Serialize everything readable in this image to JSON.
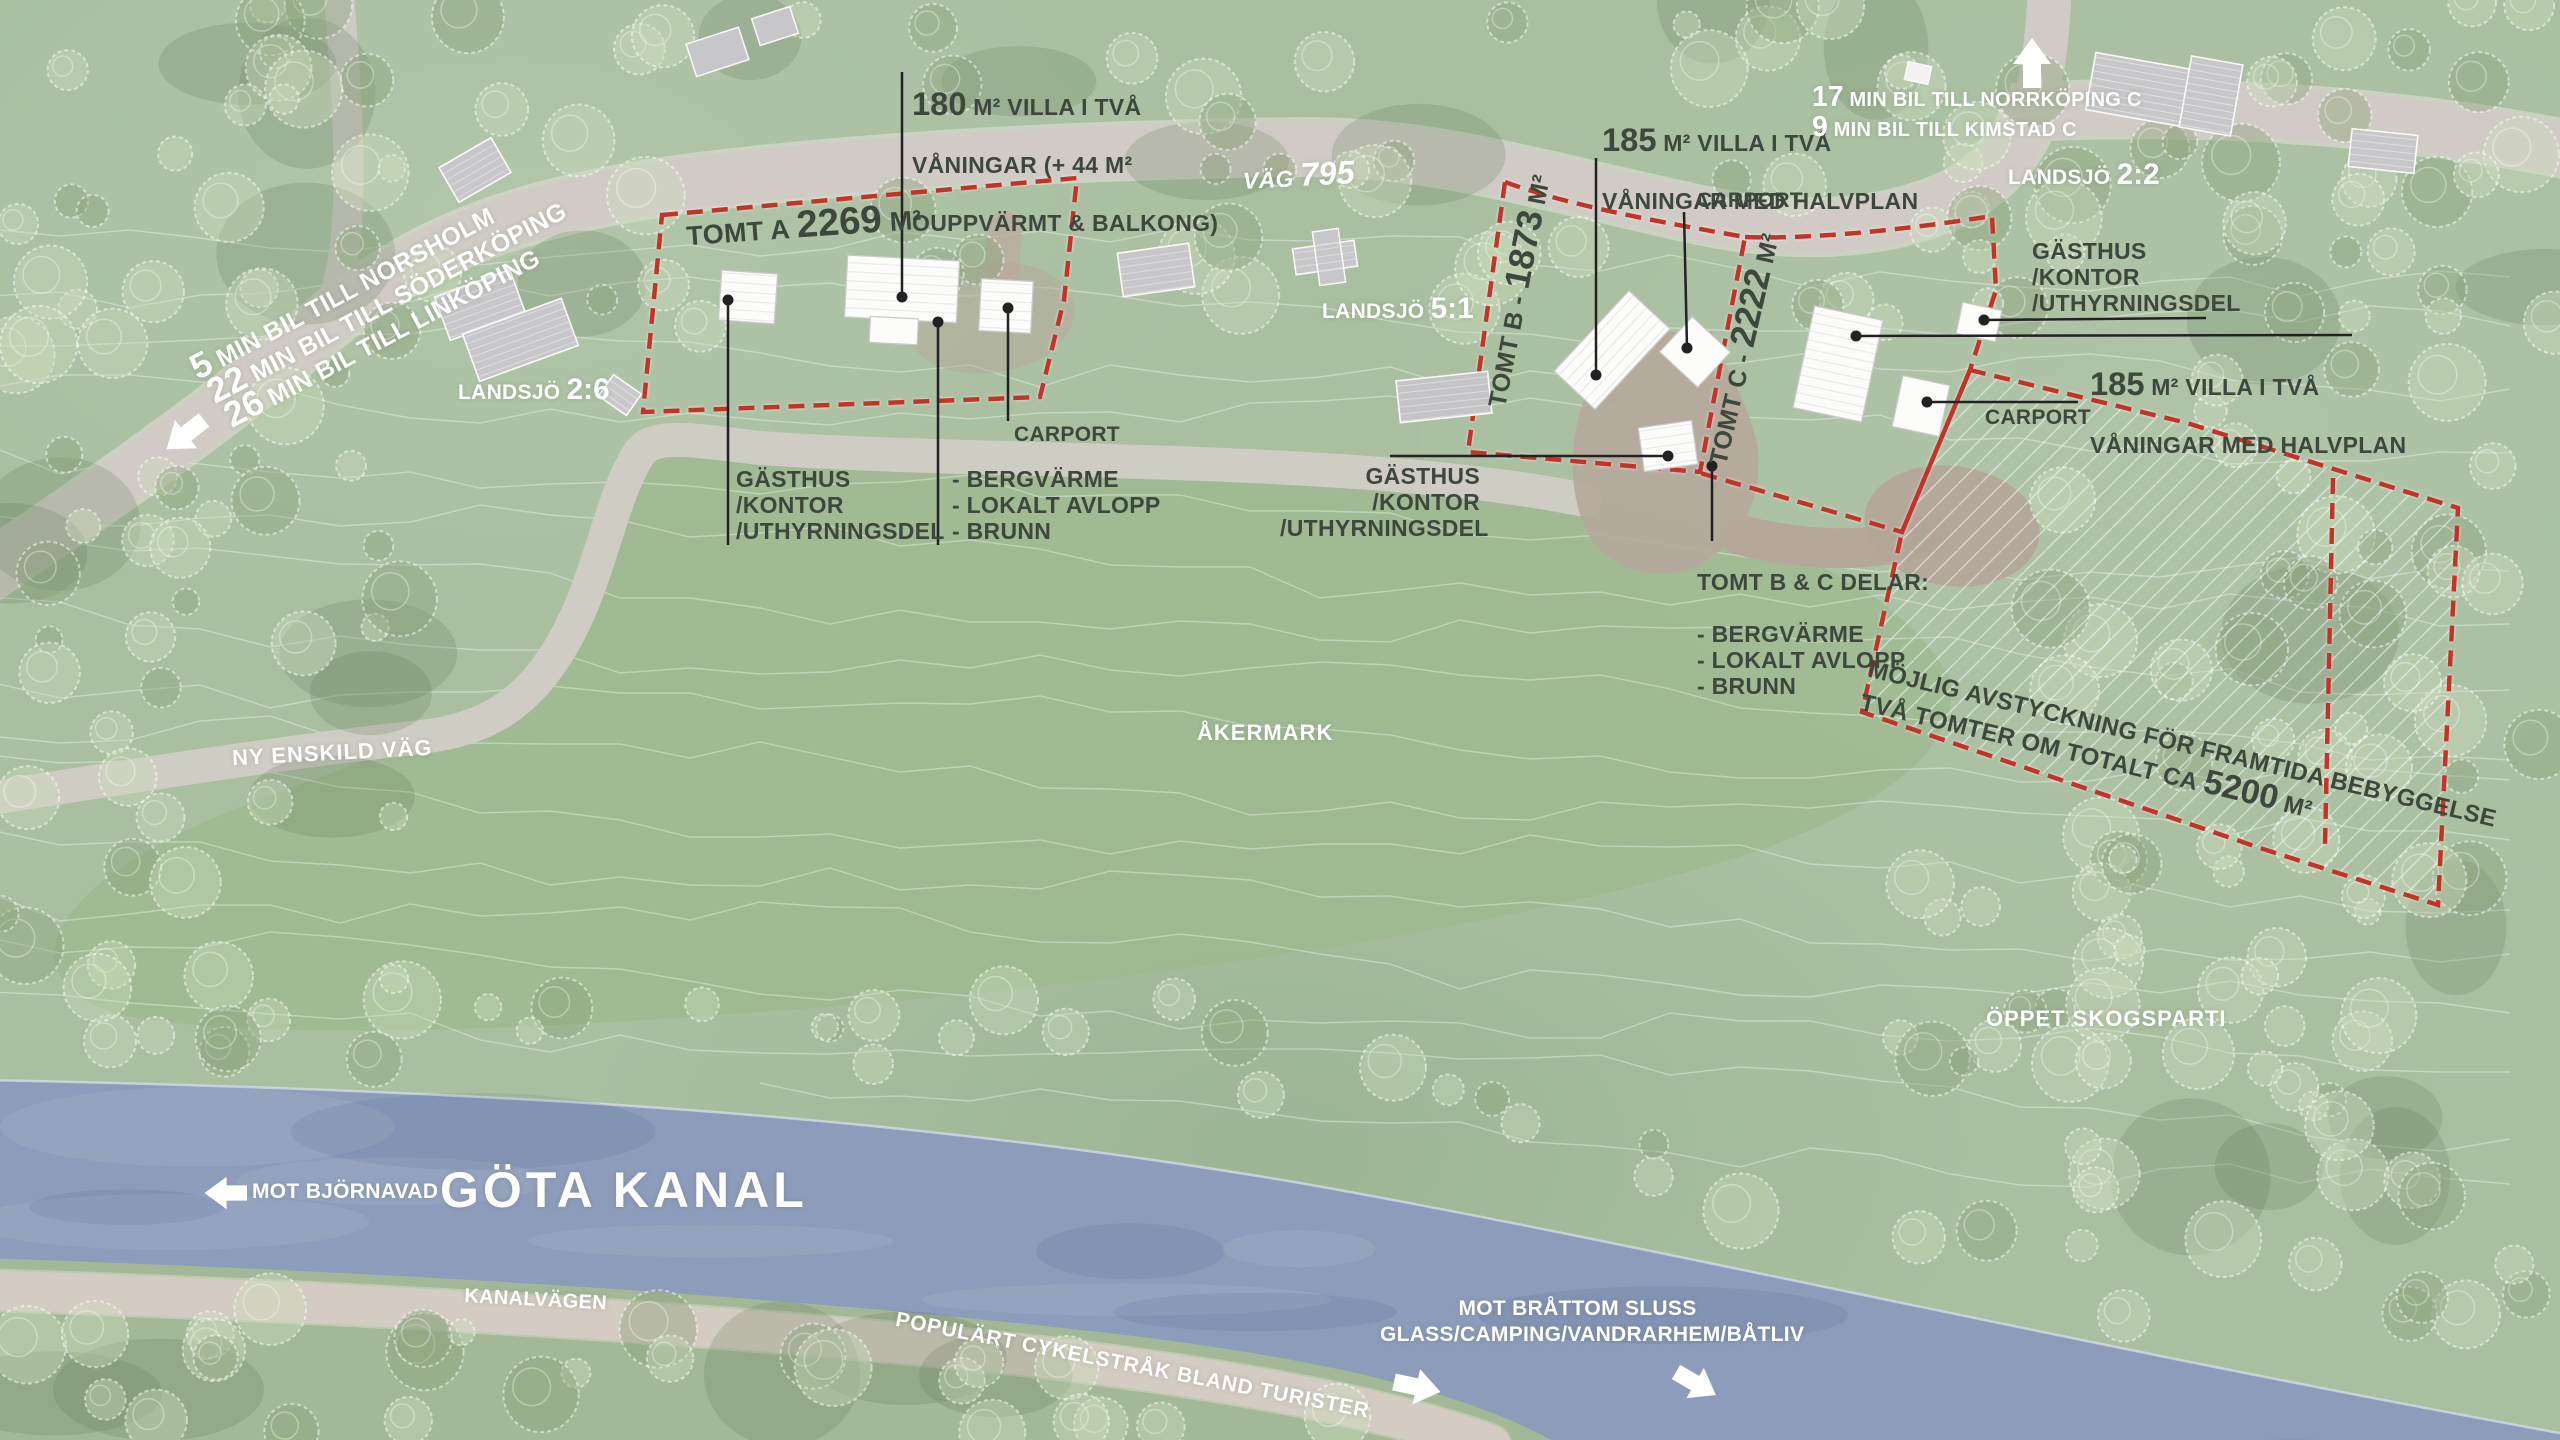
{
  "colors": {
    "background_green": "#a9bfa0",
    "field_green": "#9eb88f",
    "water_blue": "#8d9cbb",
    "road_gray": "#d0ccc5",
    "gravel_brown": "#b5a89b",
    "boundary_red": "#c23429",
    "label_dark": "#3e473c",
    "label_white": "#ffffff"
  },
  "plots": {
    "tomt_a": {
      "prefix": "TOMT A",
      "area": "2269",
      "unit": "M²"
    },
    "tomt_b": {
      "prefix": "TOMT B -",
      "area": "1873",
      "unit": "M²"
    },
    "tomt_c": {
      "prefix": "TOMT C -",
      "area": "2222",
      "unit": "M²"
    },
    "future": {
      "line1": "MÖJLIG AVSTYCKNING FÖR FRAMTIDA BEBYGGELSE",
      "line2_pre": "TVÅ TOMTER OM TOTALT CA",
      "line2_num": "5200",
      "line2_unit": "M²"
    }
  },
  "villas": {
    "villa_a": {
      "num": "180",
      "l1": " M² VILLA I TVÅ",
      "l2": "VÅNINGAR (+ 44 M²",
      "l3": "OUPPVÄRMT & BALKONG)"
    },
    "villa_b": {
      "num": "185",
      "l1": " M² VILLA I TVÅ",
      "l2": "VÅNINGAR MED HALVPLAN"
    },
    "villa_c": {
      "num": "185",
      "l1": " M² VILLA I TVÅ",
      "l2": "VÅNINGAR MED HALVPLAN"
    }
  },
  "annotations": {
    "gasthus_a": "GÄSTHUS\n/KONTOR\n/UTHYRNINGSDEL",
    "gasthus_b": "GÄSTHUS\n/KONTOR\n/UTHYRNINGSDEL",
    "gasthus_c": "GÄSTHUS\n/KONTOR\n/UTHYRNINGSDEL",
    "carport_a": "CARPORT",
    "carport_b": "CARPORT",
    "carport_c": "CARPORT",
    "utilities_a": "- BERGVÄRME\n- LOKALT AVLOPP\n- BRUNN",
    "utilities_bc_title": "TOMT B & C DELAR:",
    "utilities_bc_list": "- BERGVÄRME\n- LOKALT AVLOPP\n- BRUNN"
  },
  "roads": {
    "vag795": {
      "name": "VÄG",
      "number": "795"
    },
    "ny_enskild": "NY ENSKILD VÄG",
    "kanalvagen": "KANALVÄGEN",
    "cykelstrak": "POPULÄRT CYKELSTRÅK BLAND TURISTER"
  },
  "travel": {
    "west": [
      {
        "num": "5",
        "rest": " MIN BIL TILL NORSHOLM"
      },
      {
        "num": "22",
        "rest": " MIN BIL TILL SÖDERKÖPING"
      },
      {
        "num": "26",
        "rest": " MIN BIL TILL LINKÖPING"
      }
    ],
    "northeast": [
      {
        "num": "17",
        "rest": " MIN BIL TILL NORRKÖPING C"
      },
      {
        "num": "9",
        "rest": " MIN BIL TILL KIMSTAD C"
      }
    ]
  },
  "parcels": {
    "landsjo_26": {
      "name": "LANDSJÖ",
      "number": "2:6"
    },
    "landsjo_51": {
      "name": "LANDSJÖ",
      "number": "5:1"
    },
    "landsjo_22": {
      "name": "LANDSJÖ",
      "number": "2:2"
    }
  },
  "areas": {
    "akermark": "ÅKERMARK",
    "oppet_skogsparti": "ÖPPET SKOGSPARTI"
  },
  "canal": {
    "name": "GÖTA KANAL",
    "west": "MOT BJÖRNAVAD",
    "east": "MOT BRÅTTOM SLUSS\nGLASS/CAMPING/VANDRARHEM/BÅTLIV"
  }
}
